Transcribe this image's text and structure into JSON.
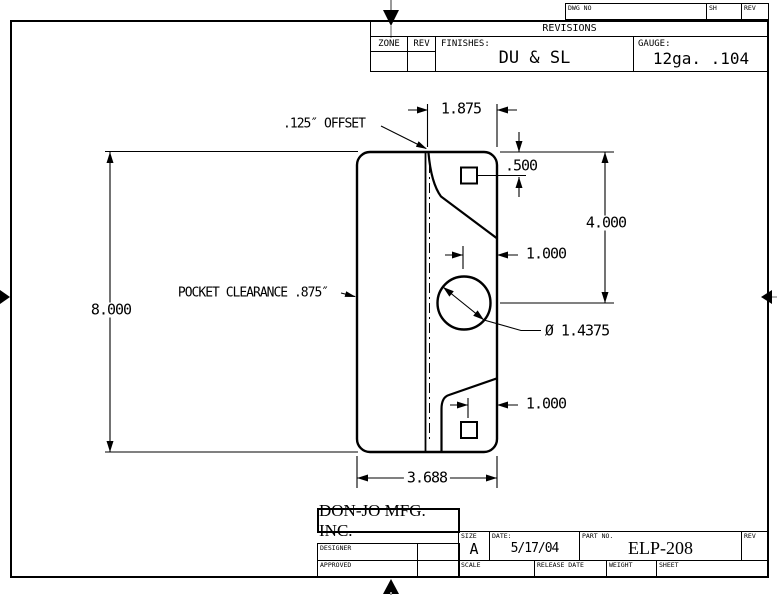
{
  "sheet": {
    "line_color": "#000000",
    "mark_stem_color": "#999999",
    "background": "#ffffff"
  },
  "top_strip": {
    "dwg_no_label": "DWG NO",
    "sh_label": "SH",
    "rev_label": "REV"
  },
  "revisions_block": {
    "title": "REVISIONS",
    "zone_label": "ZONE",
    "rev_label": "REV",
    "finishes_label": "FINISHES:",
    "finishes_value": "DU & SL",
    "gauge_label": "GAUGE:",
    "gauge_value": "12ga. .104"
  },
  "drawing": {
    "dims": {
      "flange_width": "1.875",
      "offset_note": ".125″ OFFSET",
      "hole_offset_top": ".500",
      "flange_height": "4.000",
      "hole_to_edge_mid": "1.000",
      "plate_height": "8.000",
      "pocket_note": "POCKET CLEARANCE .875″",
      "hole_diameter": "Ø 1.4375",
      "hole_to_edge_bottom": "1.000",
      "plate_width": "3.688"
    }
  },
  "title_block": {
    "company": "DON-JO MFG. INC.",
    "designer_label": "DESIGNER",
    "approved_label": "APPROVED",
    "size_label": "SIZE",
    "size_value": "A",
    "date_label": "DATE:",
    "date_value": "5/17/04",
    "part_no_label": "PART NO.",
    "part_no_value": "ELP-208",
    "rev_label": "REV",
    "scale_label": "SCALE",
    "release_date_label": "RELEASE DATE",
    "weight_label": "WEIGHT",
    "sheet_label": "SHEET"
  }
}
